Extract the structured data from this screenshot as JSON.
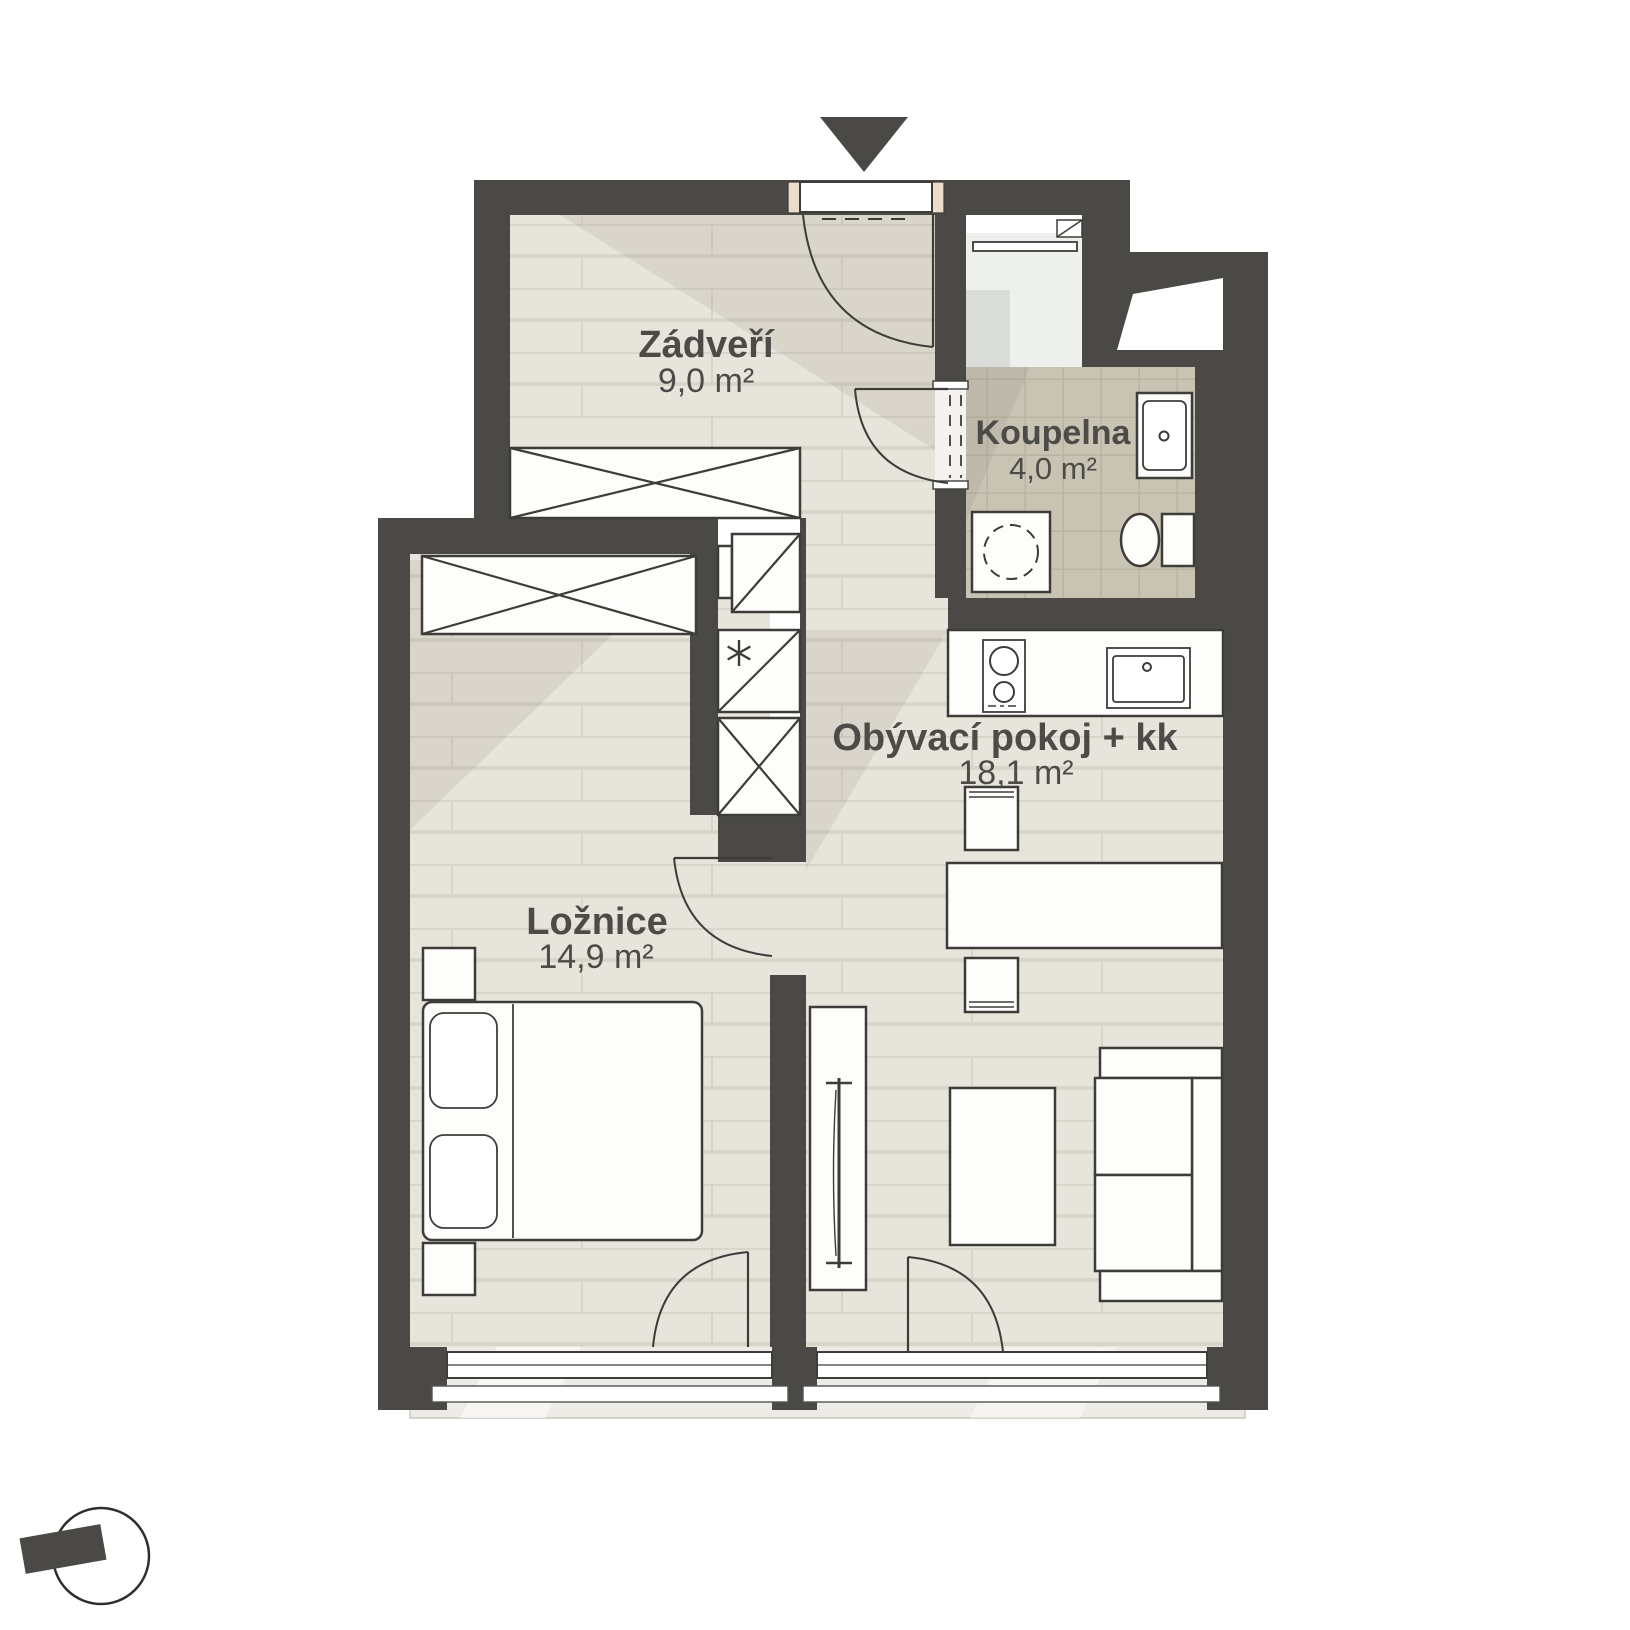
{
  "plan": {
    "rooms": [
      {
        "name": "Zádveří",
        "area": "9,0 m²"
      },
      {
        "name": "Koupelna",
        "area": "4,0 m²"
      },
      {
        "name": "Obývací pokoj + kk",
        "area": "18,1 m²"
      },
      {
        "name": "Ložnice",
        "area": "14,9 m²"
      }
    ],
    "colors": {
      "wall": "#4a4946",
      "floor_plank": "#e7e4db",
      "bathroom_tile": "#c8c3b3",
      "label_text": "#4c4b48"
    },
    "icons": [
      "entrance-arrow-icon",
      "north-compass-icon",
      "freezer-asterisk-icon"
    ]
  }
}
